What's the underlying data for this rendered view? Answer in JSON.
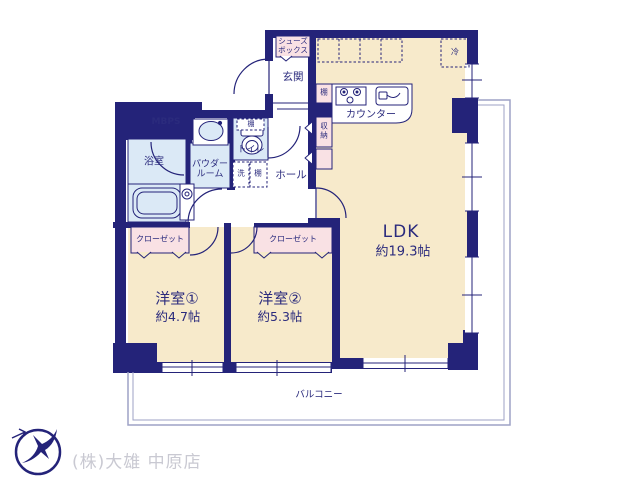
{
  "rooms": {
    "ldk": {
      "label": "LDK",
      "size": "約19.3帖"
    },
    "bedroom1": {
      "label": "洋室①",
      "size": "約4.7帖"
    },
    "bedroom2": {
      "label": "洋室②",
      "size": "約5.3帖"
    },
    "balcony": {
      "label": "バルコニー"
    },
    "entrance": {
      "label": "玄関"
    },
    "hall": {
      "label": "ホール"
    },
    "bathroom": {
      "label": "浴室"
    },
    "powder_room": {
      "label": "パウダー\nルーム"
    },
    "toilet": {
      "label": "トイレ"
    }
  },
  "fixtures": {
    "shoe_box": "シューズ\nボックス",
    "mbps": "MBPS",
    "counter": "カウンター",
    "refrigerator": "冷",
    "kitchen_shelf": "棚",
    "storage": "収\n納",
    "toilet_shelf": "棚",
    "washer": "洗",
    "laundry_shelf": "棚",
    "closet_bedroom1": "クローゼット",
    "closet_bedroom2": "クローゼット"
  },
  "footer": {
    "company": "(株)大雄 中原店"
  },
  "colors": {
    "wall": "#242379",
    "room_cream": "#f7eacb",
    "wet_blue": "#dbe9f6",
    "fixture_pink": "#f9e1e4",
    "balcony_line": "#9da2c6",
    "text": "#2b2b7d",
    "footer_text": "#c9c9d2"
  }
}
